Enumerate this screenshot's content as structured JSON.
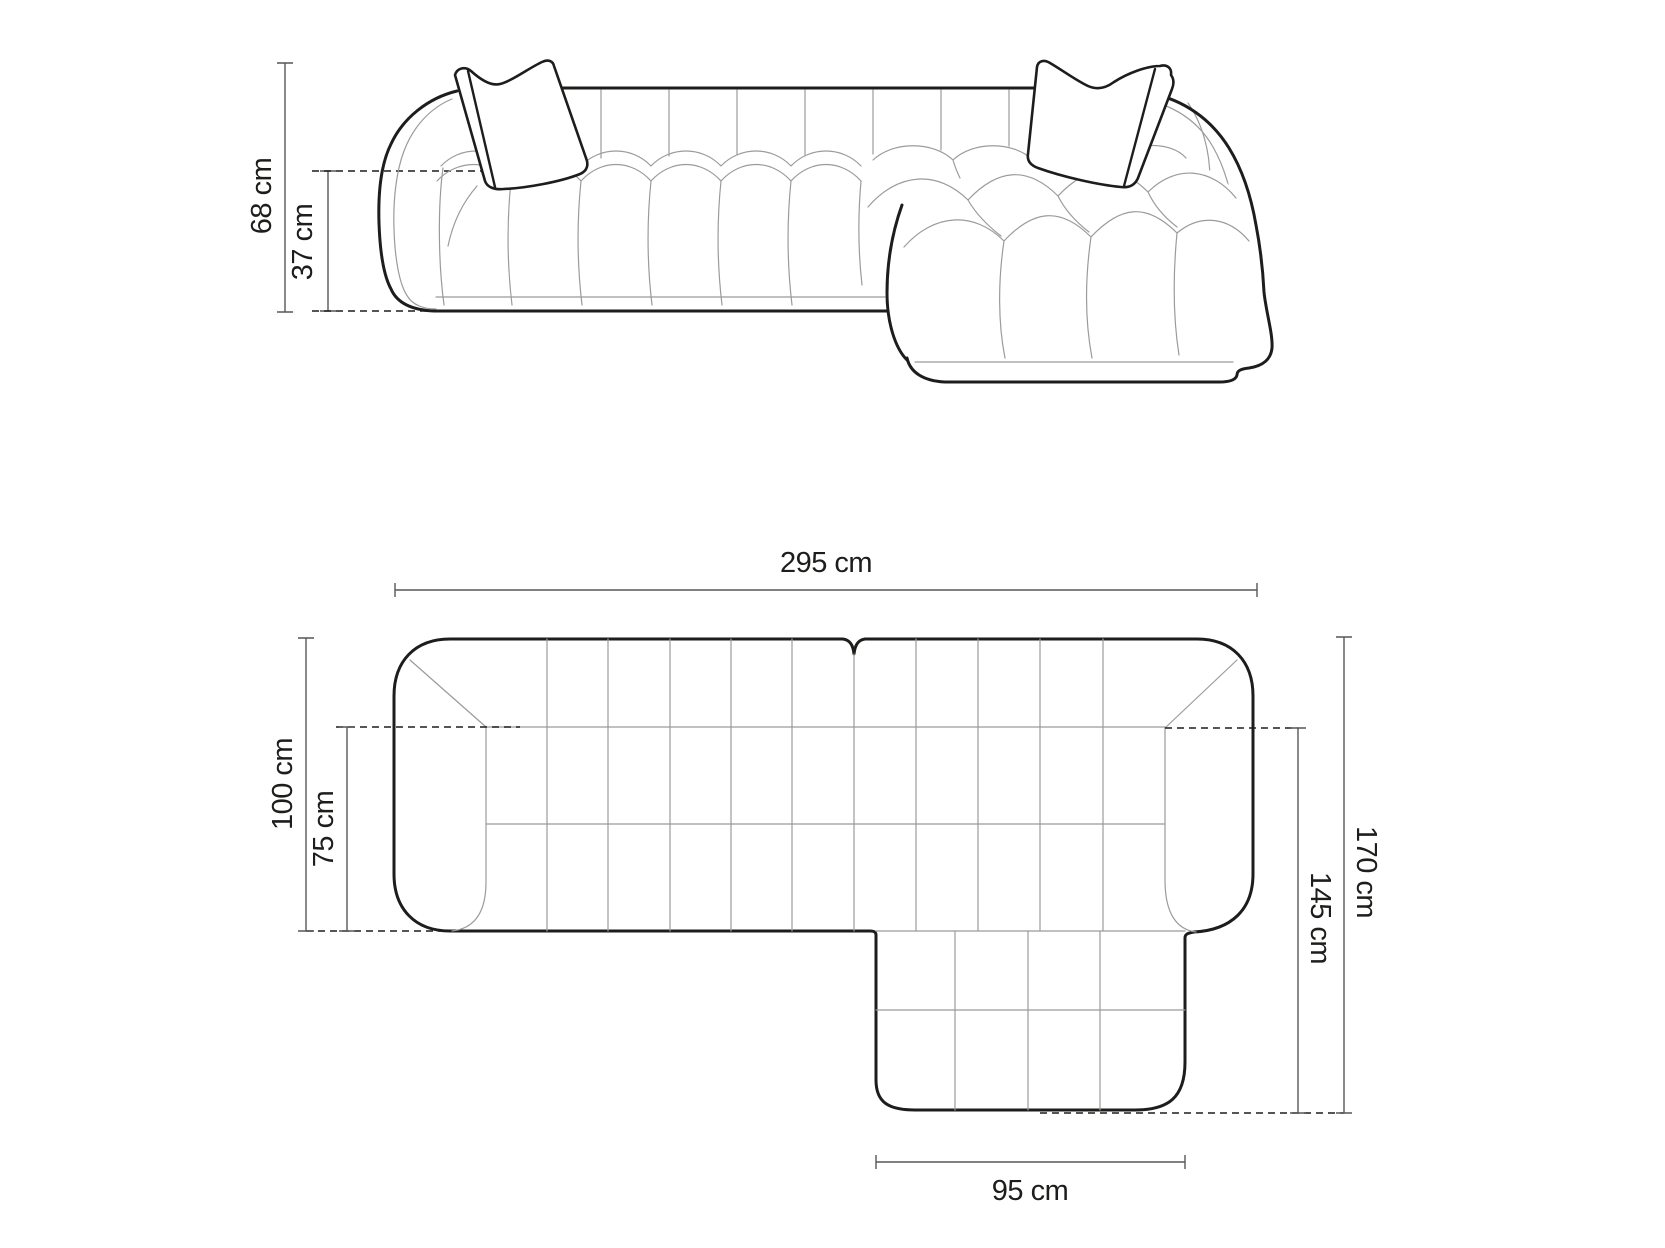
{
  "diagram": {
    "subject": "corner-sofa-dimension-drawing",
    "unit": "cm",
    "colors": {
      "background": "#ffffff",
      "outline": "#1d1d1b",
      "seam": "#9b9b9a",
      "dimension_line": "#575756",
      "text": "#1d1d1b"
    },
    "views": {
      "front_elevation": {
        "name": "front-elevation",
        "dimensions": {
          "total_height": {
            "label": "68 cm",
            "value": 68
          },
          "seat_height": {
            "label": "37 cm",
            "value": 37
          }
        }
      },
      "top_plan": {
        "name": "top-plan",
        "dimensions": {
          "total_width": {
            "label": "295 cm",
            "value": 295
          },
          "total_depth": {
            "label": "100 cm",
            "value": 100
          },
          "seat_depth": {
            "label": "75 cm",
            "value": 75
          },
          "chaise_total_depth": {
            "label": "170 cm",
            "value": 170
          },
          "chaise_inner_depth": {
            "label": "145 cm",
            "value": 145
          },
          "chaise_width": {
            "label": "95 cm",
            "value": 95
          }
        }
      }
    }
  }
}
